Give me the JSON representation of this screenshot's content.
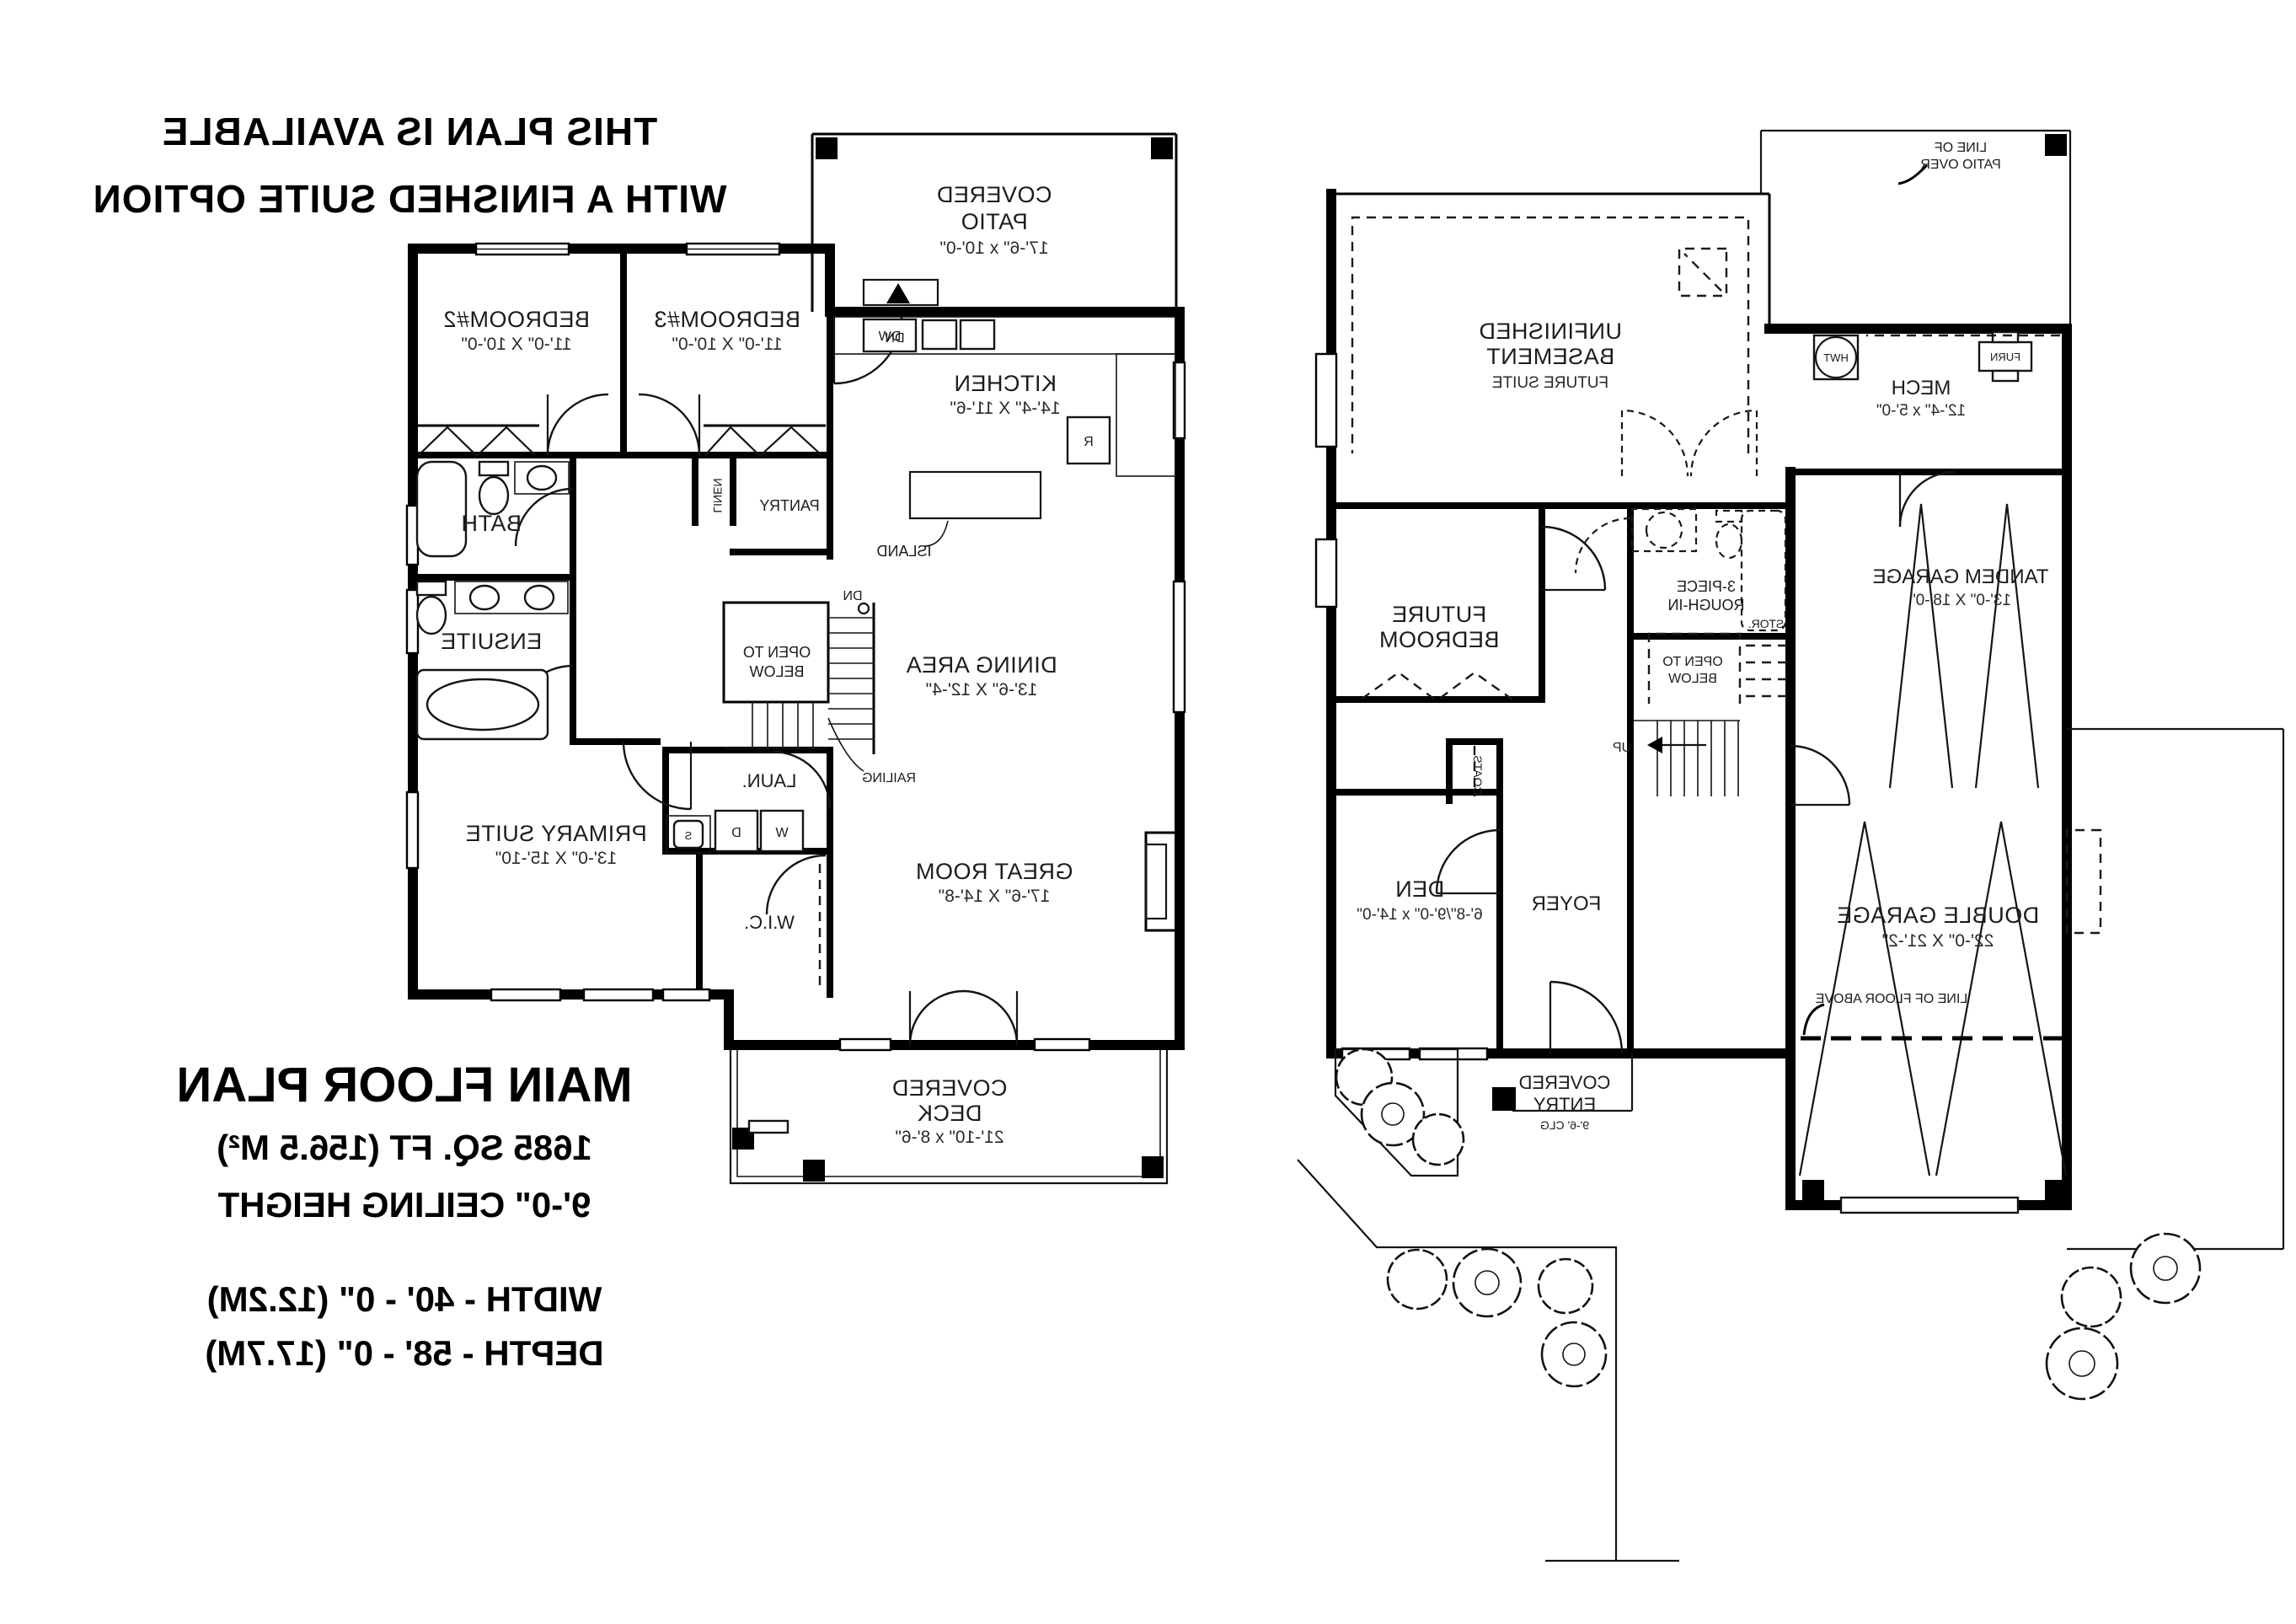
{
  "page": {
    "background": "#ffffff",
    "ink": "#000000",
    "note": "drawing is horizontally mirrored"
  },
  "notes": {
    "l1": "THIS PLAN IS AVAILABLE",
    "l2": "WITH A FINISHED SUITE OPTION"
  },
  "plan_info": {
    "title": "MAIN FLOOR PLAN",
    "area": "1685  SQ. FT (156.5 M²)",
    "ceiling": "9'-0\" CEILING HEIGHT",
    "width": "WIDTH - 40' - 0\" (12.2M)",
    "depth": "DEPTH - 58' - 0\" (17.7M)"
  },
  "mf": {
    "patio_l1": "COVERED",
    "patio_l2": "PATIO",
    "patio_d": "17'-6\" x 10'-0\"",
    "dn": "DN",
    "br3": "BEDROOM#3",
    "br3_d": "11'-0\" X 10'-0\"",
    "br2": "BEDROOM#2",
    "br2_d": "11'-0\" X 10'-0\"",
    "bath": "BATH",
    "linen": "LINEN",
    "pantry": "PANTRY",
    "ensuite": "ENSUITE",
    "kitchen": "KITCHEN",
    "kitchen_d": "14'-4\" X 11'-6\"",
    "dw": "DW",
    "r": "R",
    "island": "ISLAND",
    "dining": "DINING AREA",
    "dining_d": "13'-6\" X 12'-4\"",
    "open1": "OPEN TO",
    "open2": "BELOW",
    "railing": "RAILING",
    "laun": "LAUN.",
    "w": "W",
    "d": "D",
    "s": "S",
    "wic": "W.I.C.",
    "primary": "PRIMARY SUITE",
    "primary_d": "13'-0\" X 15'-10\"",
    "great": "GREAT ROOM",
    "great_d": "17'-6\" X 14'-8\"",
    "deck_l1": "COVERED",
    "deck_l2": "DECK",
    "deck_d": "21'-10\" x 8'-6\""
  },
  "bs": {
    "patio1": "LINE OF",
    "patio2": "PATIO OVER",
    "unf1": "UNFINISHED",
    "unf2": "BASEMENT",
    "unf3": "FUTURE SUITE",
    "mech": "MECH",
    "mech_d": "12'-4\" x 5'-0\"",
    "hwt": "HWT",
    "furn": "FURN",
    "tandem": "TANDEM GARAGE",
    "tandem_d": "13'-0\" X 18'-0\"",
    "rough1": "3-PIECE",
    "rough2": "ROUGH-IN",
    "open1": "OPEN TO",
    "open2": "BELOW",
    "stor": "STOR.",
    "up": "UP",
    "fbed1": "FUTURE",
    "fbed2": "BEDROOM",
    "den": "DEN",
    "den_d": "6'-8\"/9'-0\" x 14'-0\"",
    "coats": "COATS",
    "foyer": "FOYER",
    "entry1": "COVERED",
    "entry2": "ENTRY",
    "entry3": "9'-6' CLG",
    "dgar": "DOUBLE GARAGE",
    "dgar_d": "22'-0\" X 21'-2\"",
    "lfa": "LINE OF FLOOR ABOVE"
  }
}
